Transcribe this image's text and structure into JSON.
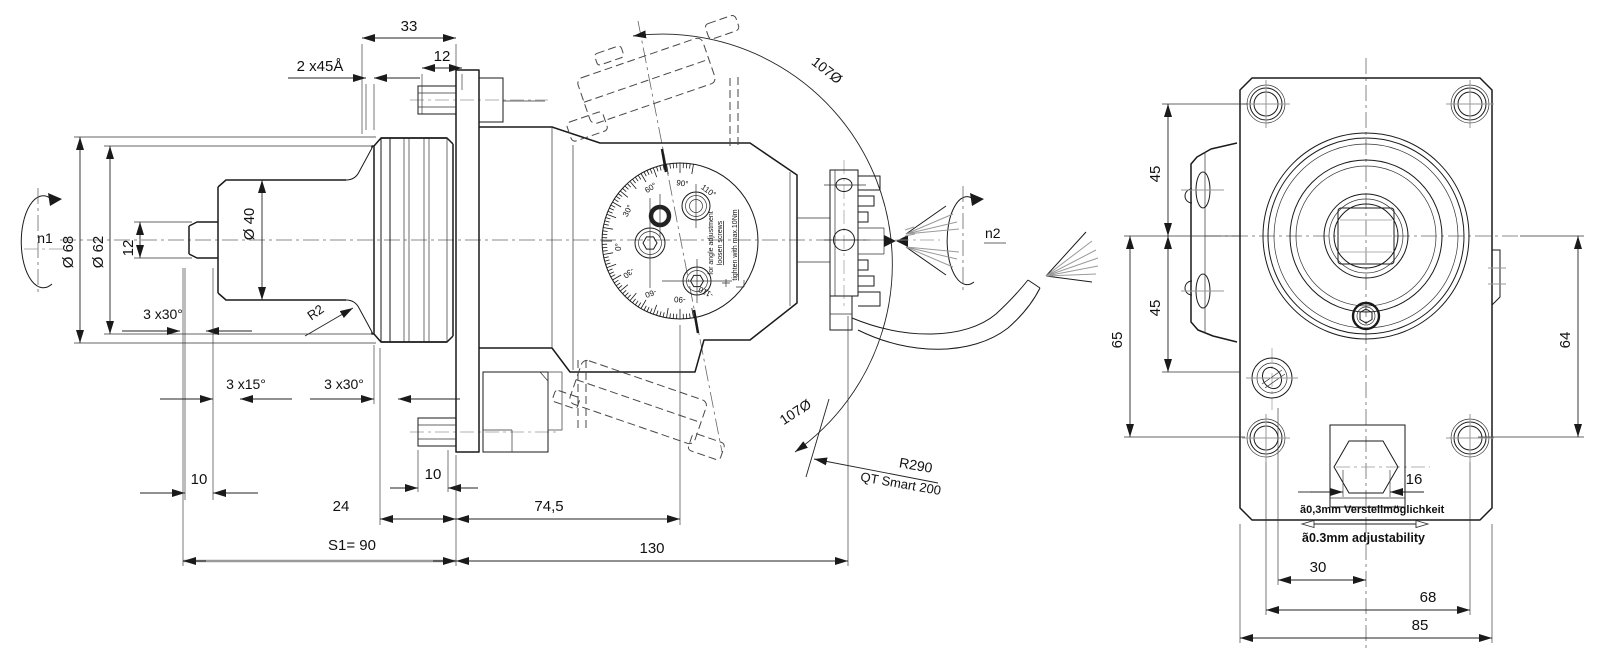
{
  "left_view": {
    "labels": {
      "n1": "n1",
      "n2": "n2"
    },
    "dims": {
      "d33": "33",
      "d12_top": "12",
      "chamfer2x45": "2 x45Å",
      "dia68": "Ø 68",
      "dia62": "Ø 62",
      "d12_step": "12",
      "dia40": "Ø 40",
      "ch30a": "3 x30°",
      "ch15": "3 x15°",
      "ch30b": "3 x30°",
      "r2": "R2",
      "d10_left": "10",
      "d10_right": "10",
      "d24": "24",
      "d745": "74,5",
      "s1": "S1=  90",
      "d130": "130",
      "arc_top": "107Ø",
      "arc_bottom": "107Ø",
      "r290": "R290",
      "model": "QT Smart 200"
    },
    "dial": {
      "pos": [
        "0°",
        "30°",
        "60°",
        "90°",
        "110°"
      ],
      "neg": [
        "-30",
        "-60",
        "-90",
        "-110"
      ],
      "notes": [
        "for angle adjustment",
        "loosen screws",
        "tighten with max.10Nm"
      ]
    }
  },
  "right_view": {
    "dims": {
      "d45a": "45",
      "d45b": "45",
      "d65": "65",
      "d64": "64",
      "d16": "16",
      "adj_de": "ã0,3mm Verstellmöglichkeit",
      "adj_en": "ã0.3mm adjustability",
      "d30": "30",
      "d68": "68",
      "d85": "85"
    }
  },
  "colors": {
    "line": "#1a1a1a",
    "dim": "#222222",
    "gray": "#9a9a9a",
    "background": "#ffffff"
  }
}
